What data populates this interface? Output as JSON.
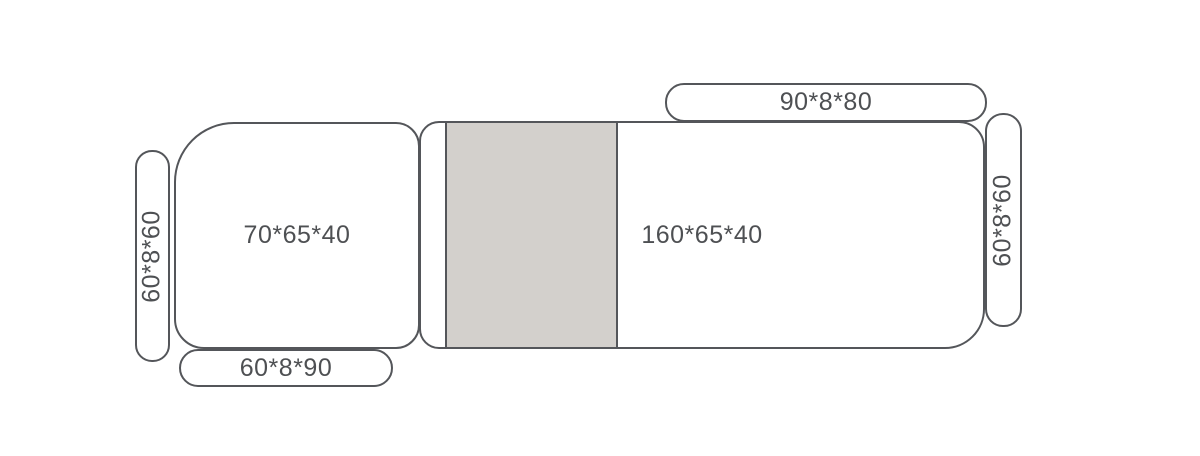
{
  "diagram_title": "modular-sofa-dimension-layout",
  "colors": {
    "background": "#ffffff",
    "outline": "#54565a",
    "label": "#4e5053",
    "chaise_fill": "#d3d0cc"
  },
  "modules": {
    "left_armrest": {
      "label": "60*8*60"
    },
    "left_seat": {
      "label": "70*65*40"
    },
    "front_cushion": {
      "label": "60*8*90"
    },
    "right_seat": {
      "label": "160*65*40"
    },
    "back_cushion": {
      "label": "90*8*80"
    },
    "right_armrest": {
      "label": "60*8*60"
    }
  }
}
